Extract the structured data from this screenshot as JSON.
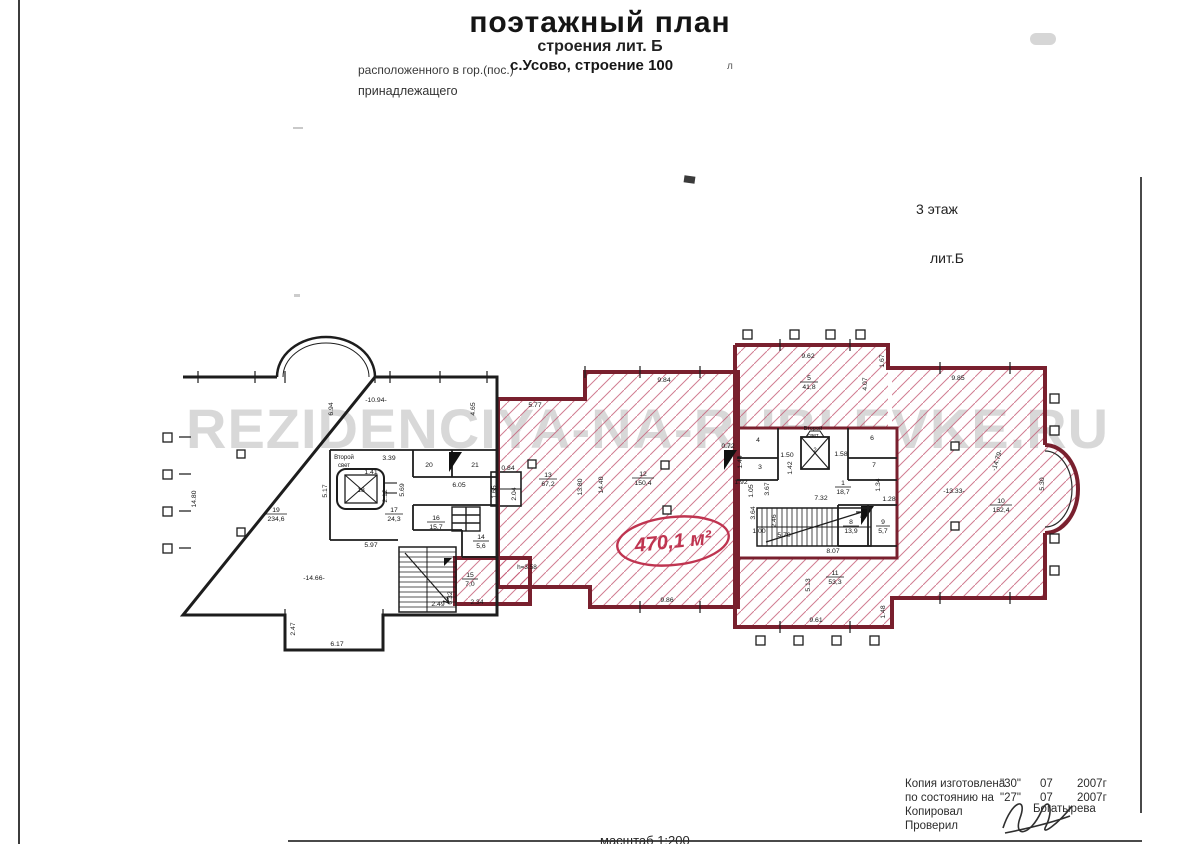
{
  "page": {
    "title": "поэтажный план",
    "subtitle": "строения лит. Б",
    "location_label": "расположенного в гор.(пос.)",
    "location_value": "с.Усово, строение 100",
    "owner_label": "принадлежащего",
    "floor_label": "3 этаж",
    "liter_label": "лит.Б",
    "scale_label": "масштаб 1:200",
    "watermark": "REZIDENCIYA-NA-RUBLEVKE.RU",
    "stray_mark": "л"
  },
  "stamp": {
    "made_label": "Копия изготовлена",
    "made_day": "\"30\"",
    "made_month": "07",
    "made_year": "2007г",
    "asof_label": "по состоянию на",
    "asof_day": "\"27\"",
    "asof_month": "07",
    "asof_year": "2007г",
    "copied_label": "Копировал",
    "checked_label": "Проверил",
    "surname": "Богатырева"
  },
  "plan": {
    "area_note": "470,1 м²",
    "second_light_top": "Второй",
    "second_light_bottom": "свет",
    "height_note": "h=3.58",
    "rooms": {
      "r1": {
        "num": "1",
        "area": "18,7"
      },
      "r2": {
        "num": "2",
        "area": ""
      },
      "r3": {
        "num": "3",
        "area": ""
      },
      "r4": {
        "num": "4",
        "area": ""
      },
      "r5": {
        "num": "5",
        "area": "41,8"
      },
      "r6": {
        "num": "6",
        "area": ""
      },
      "r7": {
        "num": "7",
        "area": ""
      },
      "r8": {
        "num": "8",
        "area": "13,9"
      },
      "r9": {
        "num": "9",
        "area": "5,7"
      },
      "r10": {
        "num": "10",
        "area": "152,4"
      },
      "r11": {
        "num": "11",
        "area": "53,3"
      },
      "r12": {
        "num": "12",
        "area": "150,4"
      },
      "r13": {
        "num": "13",
        "area": "67,2"
      },
      "r14": {
        "num": "14",
        "area": "5,6"
      },
      "r15": {
        "num": "15",
        "area": "7,0"
      },
      "r16": {
        "num": "16",
        "area": "15,7"
      },
      "r17": {
        "num": "17",
        "area": "24,3"
      },
      "r18": {
        "num": "18",
        "area": ""
      },
      "r19": {
        "num": "19",
        "area": "234,6"
      },
      "r20": {
        "num": "20",
        "area": ""
      },
      "r21": {
        "num": "21",
        "area": ""
      }
    },
    "dims": [
      "14.80",
      "6.94",
      "-10.94-",
      "4.65",
      "1.41",
      "3.39",
      "5.17",
      "2.12",
      "5.69",
      "6.05",
      "5.97",
      "-14.66-",
      "2.49",
      "2.34",
      "6.32",
      "2.47",
      "6.17",
      "0.84",
      "1.65",
      "2.04",
      "5.77",
      "13.80",
      "14.40",
      "9.84",
      "9.86",
      "9.62",
      "1.67",
      "4.07",
      "9.85",
      "1.50",
      "1.58",
      "1.42",
      "0.72",
      "1.44",
      "1.92",
      "3.67",
      "1.05",
      "7.32",
      "1.28",
      "1.34",
      "3.64",
      "2.46",
      "1.00",
      "5.70",
      "8.07",
      "5.13",
      "9.61",
      "1.48",
      "-13.33-",
      "-14.79-",
      "5.30"
    ]
  }
}
